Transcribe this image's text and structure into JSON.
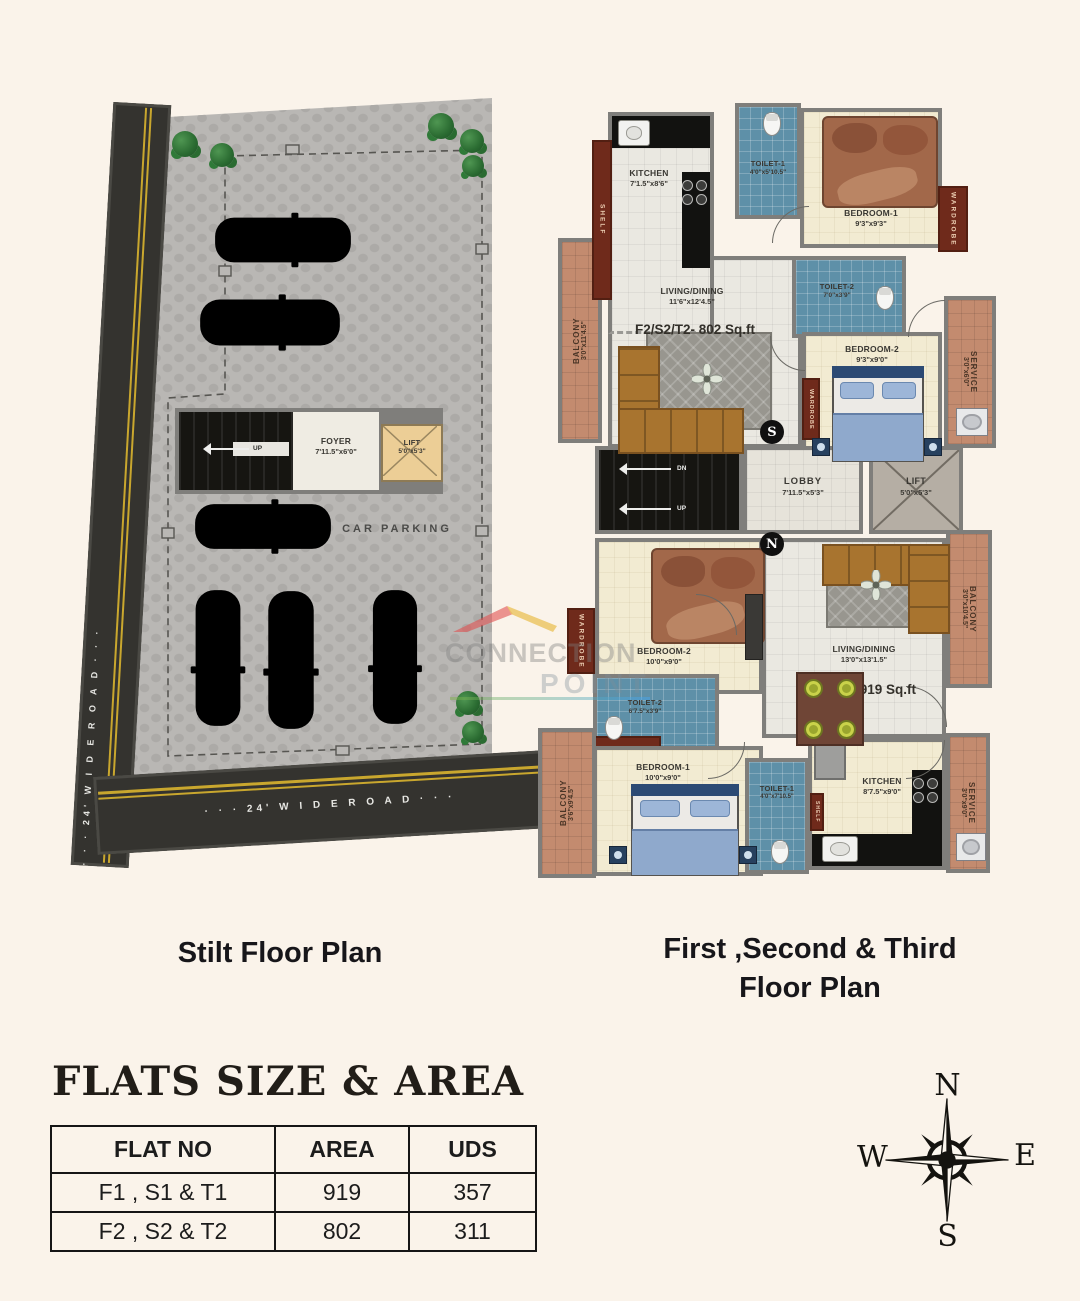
{
  "stilt_plan": {
    "title": "Stilt Floor Plan",
    "road_left_label": "· · ·  24' W I D E R O A D  · · ·",
    "road_bottom_label": "· · ·  24' W I D E R O A D  · · ·",
    "car_parking_label": "CAR PARKING",
    "up_label": "UP",
    "foyer": {
      "name": "FOYER",
      "dims": "7'11.5\"x6'0\""
    },
    "lift": {
      "name": "LIFT",
      "dims": "5'0\"x5'3\""
    }
  },
  "floor_plan": {
    "title_line1": "First ,Second & Third",
    "title_line2": "Floor Plan",
    "wardrobe_label": "WARDROBE",
    "shelf_label": "SHELF",
    "unit_f2": {
      "kitchen": {
        "name": "KITCHEN",
        "dims": "7'1.5\"x8'6\""
      },
      "toilet1": {
        "name": "TOILET-1",
        "dims": "4'0\"x5'10.5\""
      },
      "bedroom1": {
        "name": "BEDROOM-1",
        "dims": "9'3\"x9'3\""
      },
      "toilet2": {
        "name": "TOILET-2",
        "dims": "7'0\"x3'9\""
      },
      "bedroom2": {
        "name": "BEDROOM-2",
        "dims": "9'3\"x9'0\""
      },
      "living": {
        "name": "LIVING/DINING",
        "dims": "11'6\"x12'4.5\""
      },
      "unit_area": "F2/S2/T2- 802 Sq.ft",
      "balcony": {
        "name": "BALCONY",
        "dims": "3'0\"x11'4.5\""
      },
      "service": {
        "name": "SERVICE",
        "dims": "3'0\"x6'0\""
      }
    },
    "core": {
      "lobby": {
        "name": "LOBBY",
        "dims": "7'11.5\"x5'3\""
      },
      "lift": {
        "name": "LIFT",
        "dims": "5'0\"x5'3\""
      },
      "dn_label": "DN",
      "up_label": "UP",
      "south_marker": "S",
      "north_marker": "N"
    },
    "unit_f1": {
      "bedroom2": {
        "name": "BEDROOM-2",
        "dims": "10'0\"x9'0\""
      },
      "living": {
        "name": "LIVING/DINING",
        "dims": "13'0\"x13'1.5\""
      },
      "unit_area": "F1/S2/T2- 919 Sq.ft",
      "toilet2": {
        "name": "TOILET-2",
        "dims": "6'7.5\"x3'9\""
      },
      "bedroom1": {
        "name": "BEDROOM-1",
        "dims": "10'0\"x9'0\""
      },
      "toilet1": {
        "name": "TOILET-1",
        "dims": "4'0\"x7'10.5\""
      },
      "kitchen": {
        "name": "KITCHEN",
        "dims": "8'7.5\"x9'0\""
      },
      "balcony_left": {
        "name": "BALCONY",
        "dims": "3'6\"x9'4.5\""
      },
      "balcony_right": {
        "name": "BALCONY",
        "dims": "3'0\"x10'4.5\""
      },
      "service": {
        "name": "SERVICE",
        "dims": "3'0\"x9'0\""
      }
    }
  },
  "flats_table": {
    "title": "FLATS SIZE & AREA",
    "headers": [
      "FLAT NO",
      "AREA",
      "UDS"
    ],
    "rows": [
      [
        "F1 , S1 & T1",
        "919",
        "357"
      ],
      [
        "F2 , S2 & T2",
        "802",
        "311"
      ]
    ]
  },
  "compass": {
    "north": "N",
    "east": "E",
    "south": "S",
    "west": "W"
  },
  "watermark": {
    "line1": "CONNECTION",
    "line2": "POINT"
  }
}
